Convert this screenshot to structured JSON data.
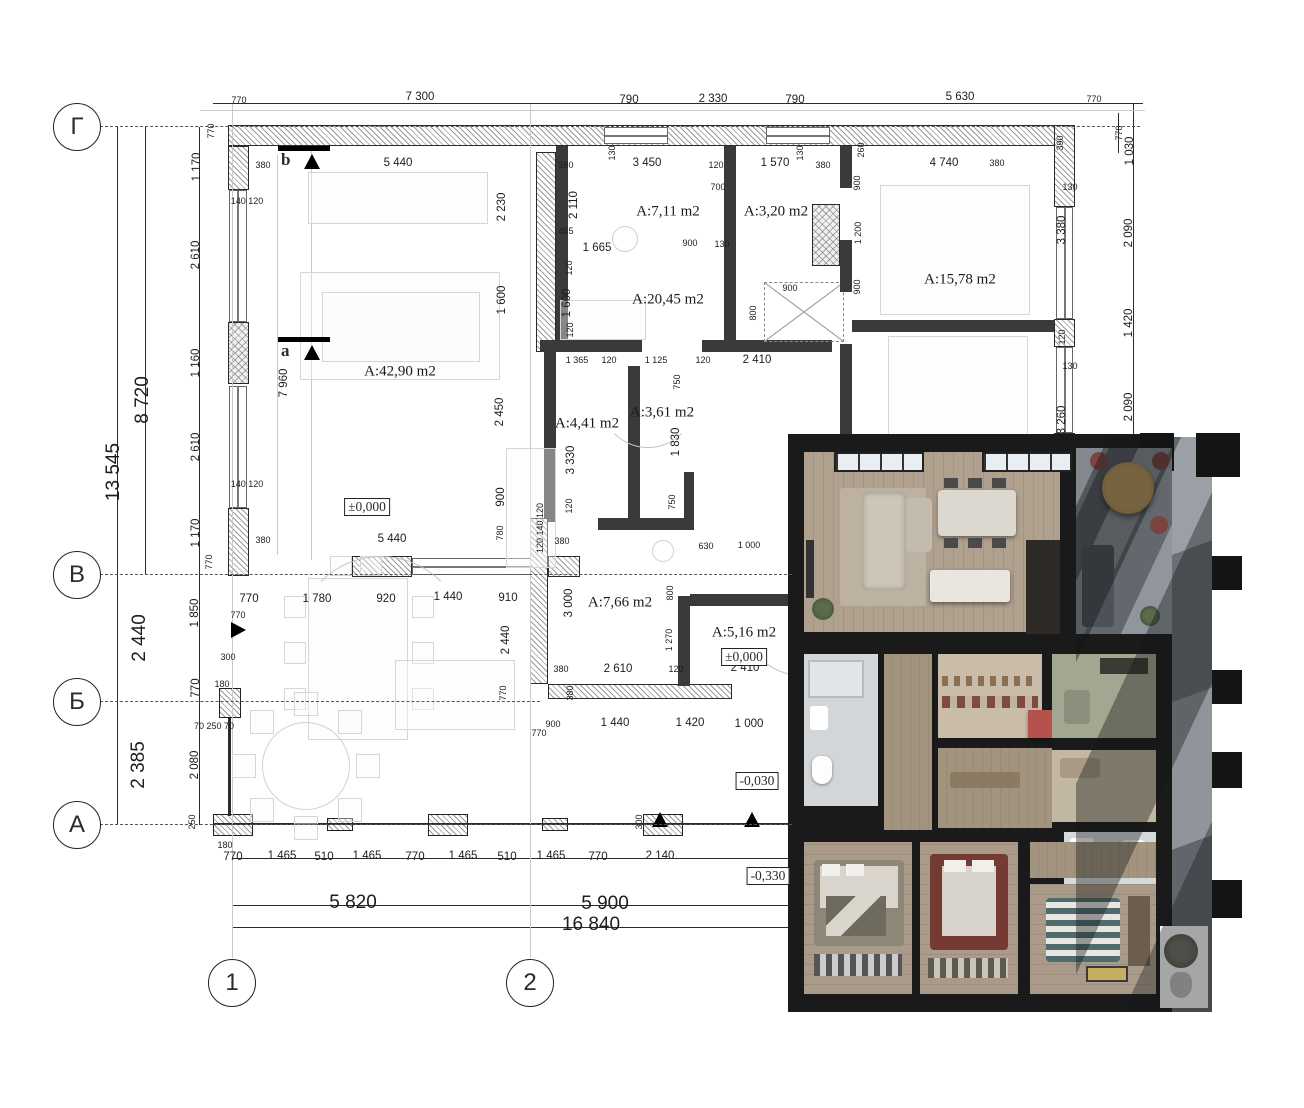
{
  "title": "apartment floor plan with 3d render overlay",
  "colors": {
    "plan_line": "#2b2b2b",
    "wall_hatch": "#9a9a9a",
    "render_wall": "#1a1a1a",
    "render_wood": "#ab9c8b",
    "render_terrace": "#8d9398",
    "render_accent_red": "#b5524c"
  },
  "axes": {
    "rows": [
      {
        "label": "Г",
        "y": 127
      },
      {
        "label": "В",
        "y": 575
      },
      {
        "label": "Б",
        "y": 702
      },
      {
        "label": "А",
        "y": 825
      }
    ],
    "cols": [
      {
        "label": "1",
        "x": 232
      },
      {
        "label": "2",
        "x": 530
      }
    ]
  },
  "rooms": [
    {
      "t": "A:42,90 m2",
      "x": 400,
      "y": 372
    },
    {
      "t": "A:7,11 m2",
      "x": 668,
      "y": 212
    },
    {
      "t": "A:3,20 m2",
      "x": 776,
      "y": 212
    },
    {
      "t": "A:20,45 m2",
      "x": 668,
      "y": 300
    },
    {
      "t": "A:15,78 m2",
      "x": 960,
      "y": 280
    },
    {
      "t": "A:4,41 m2",
      "x": 587,
      "y": 424
    },
    {
      "t": "A:3,61 m2",
      "x": 662,
      "y": 413
    },
    {
      "t": "A:7,66 m2",
      "x": 620,
      "y": 603
    },
    {
      "t": "A:5,16 m2",
      "x": 744,
      "y": 633
    }
  ],
  "levels": [
    {
      "t": "±0,000",
      "x": 367,
      "y": 507
    },
    {
      "t": "±0,000",
      "x": 744,
      "y": 657
    },
    {
      "t": "-0,030",
      "x": 757,
      "y": 781
    },
    {
      "t": "-0,330",
      "x": 768,
      "y": 876
    }
  ],
  "sections": [
    {
      "label": "b",
      "x": 287,
      "y": 158
    },
    {
      "label": "a",
      "x": 287,
      "y": 349
    }
  ],
  "dims": [
    {
      "t": "770",
      "x": 239,
      "y": 100,
      "s": 1
    },
    {
      "t": "7 300",
      "x": 420,
      "y": 97
    },
    {
      "t": "790",
      "x": 629,
      "y": 100
    },
    {
      "t": "2 330",
      "x": 713,
      "y": 99
    },
    {
      "t": "790",
      "x": 795,
      "y": 100
    },
    {
      "t": "5 630",
      "x": 960,
      "y": 97
    },
    {
      "t": "770",
      "x": 1094,
      "y": 99,
      "s": 1
    },
    {
      "t": "380",
      "x": 263,
      "y": 165,
      "s": 1
    },
    {
      "t": "5 440",
      "x": 398,
      "y": 163
    },
    {
      "t": "380",
      "x": 566,
      "y": 165,
      "s": 1
    },
    {
      "t": "3 450",
      "x": 647,
      "y": 163
    },
    {
      "t": "120",
      "x": 716,
      "y": 165,
      "s": 1
    },
    {
      "t": "1 570",
      "x": 775,
      "y": 163
    },
    {
      "t": "380",
      "x": 823,
      "y": 165,
      "s": 1
    },
    {
      "t": "260",
      "x": 861,
      "y": 150,
      "r": 1,
      "s": 1
    },
    {
      "t": "4 740",
      "x": 944,
      "y": 163
    },
    {
      "t": "380",
      "x": 997,
      "y": 163,
      "s": 1
    },
    {
      "t": "390",
      "x": 1060,
      "y": 143,
      "r": 1,
      "s": 1
    },
    {
      "t": "130",
      "x": 612,
      "y": 153,
      "r": 1,
      "s": 1
    },
    {
      "t": "130",
      "x": 800,
      "y": 153,
      "r": 1,
      "s": 1
    },
    {
      "t": "130",
      "x": 1070,
      "y": 187,
      "s": 1
    },
    {
      "t": "130",
      "x": 1070,
      "y": 366,
      "s": 1
    },
    {
      "t": "770",
      "x": 211,
      "y": 131,
      "r": 1,
      "s": 1
    },
    {
      "t": "1 170",
      "x": 197,
      "y": 167,
      "r": 1
    },
    {
      "t": "2 610",
      "x": 196,
      "y": 255,
      "r": 1
    },
    {
      "t": "1 160",
      "x": 196,
      "y": 363,
      "r": 1
    },
    {
      "t": "2 610",
      "x": 196,
      "y": 447,
      "r": 1
    },
    {
      "t": "1 170",
      "x": 196,
      "y": 533,
      "r": 1
    },
    {
      "t": "770",
      "x": 209,
      "y": 562,
      "r": 1,
      "s": 1
    },
    {
      "t": "8 720",
      "x": 143,
      "y": 400,
      "r": 1,
      "s": 4
    },
    {
      "t": "13 545",
      "x": 114,
      "y": 472,
      "r": 1,
      "s": 4
    },
    {
      "t": "1 850",
      "x": 195,
      "y": 613,
      "r": 1
    },
    {
      "t": "2 440",
      "x": 140,
      "y": 638,
      "r": 1,
      "s": 4
    },
    {
      "t": "770",
      "x": 196,
      "y": 688,
      "r": 1
    },
    {
      "t": "300",
      "x": 228,
      "y": 657,
      "s": 1
    },
    {
      "t": "180",
      "x": 222,
      "y": 684,
      "s": 1
    },
    {
      "t": "2 080",
      "x": 195,
      "y": 765,
      "r": 1
    },
    {
      "t": "2 385",
      "x": 139,
      "y": 765,
      "r": 1,
      "s": 4
    },
    {
      "t": "250",
      "x": 192,
      "y": 822,
      "r": 1,
      "s": 1
    },
    {
      "t": "70 250 70",
      "x": 214,
      "y": 726,
      "s": 1
    },
    {
      "t": "770",
      "x": 238,
      "y": 615,
      "s": 1
    },
    {
      "t": "770",
      "x": 1119,
      "y": 133,
      "r": 1,
      "s": 1
    },
    {
      "t": "1 030",
      "x": 1130,
      "y": 151,
      "r": 1
    },
    {
      "t": "2 090",
      "x": 1129,
      "y": 233,
      "r": 1
    },
    {
      "t": "1 420",
      "x": 1129,
      "y": 323,
      "r": 1
    },
    {
      "t": "2 090",
      "x": 1129,
      "y": 407,
      "r": 1
    },
    {
      "t": "2 230",
      "x": 502,
      "y": 207,
      "r": 1
    },
    {
      "t": "1 600",
      "x": 502,
      "y": 300,
      "r": 1
    },
    {
      "t": "2 450",
      "x": 500,
      "y": 412,
      "r": 1
    },
    {
      "t": "900",
      "x": 501,
      "y": 497,
      "r": 1
    },
    {
      "t": "780",
      "x": 500,
      "y": 533,
      "r": 1,
      "s": 1
    },
    {
      "t": "140 120",
      "x": 247,
      "y": 201,
      "s": 1
    },
    {
      "t": "140 120",
      "x": 247,
      "y": 484,
      "s": 1
    },
    {
      "t": "7 960",
      "x": 284,
      "y": 383,
      "r": 1
    },
    {
      "t": "2 110",
      "x": 574,
      "y": 205,
      "r": 1
    },
    {
      "t": "465",
      "x": 566,
      "y": 231,
      "s": 1
    },
    {
      "t": "1 665",
      "x": 597,
      "y": 248
    },
    {
      "t": "900",
      "x": 690,
      "y": 243,
      "s": 1
    },
    {
      "t": "130",
      "x": 722,
      "y": 244,
      "s": 1
    },
    {
      "t": "700",
      "x": 718,
      "y": 187,
      "s": 1
    },
    {
      "t": "120",
      "x": 569,
      "y": 268,
      "r": 1,
      "s": 1
    },
    {
      "t": "1 600",
      "x": 567,
      "y": 303,
      "r": 1
    },
    {
      "t": "120",
      "x": 570,
      "y": 330,
      "r": 1,
      "s": 1
    },
    {
      "t": "900",
      "x": 790,
      "y": 288,
      "s": 1
    },
    {
      "t": "800",
      "x": 753,
      "y": 313,
      "r": 1,
      "s": 1
    },
    {
      "t": "900",
      "x": 857,
      "y": 183,
      "r": 1,
      "s": 1
    },
    {
      "t": "1 200",
      "x": 858,
      "y": 233,
      "r": 1,
      "s": 1
    },
    {
      "t": "900",
      "x": 857,
      "y": 287,
      "r": 1,
      "s": 1
    },
    {
      "t": "3 380",
      "x": 1062,
      "y": 230,
      "r": 1
    },
    {
      "t": "120",
      "x": 1062,
      "y": 337,
      "r": 1,
      "s": 1
    },
    {
      "t": "3 260",
      "x": 1062,
      "y": 420,
      "r": 1
    },
    {
      "t": "1 365",
      "x": 577,
      "y": 360,
      "s": 1
    },
    {
      "t": "120",
      "x": 609,
      "y": 360,
      "s": 1
    },
    {
      "t": "1 125",
      "x": 656,
      "y": 360,
      "s": 1
    },
    {
      "t": "750",
      "x": 677,
      "y": 382,
      "r": 1,
      "s": 1
    },
    {
      "t": "120",
      "x": 703,
      "y": 360,
      "s": 1
    },
    {
      "t": "2 410",
      "x": 757,
      "y": 360
    },
    {
      "t": "3 330",
      "x": 571,
      "y": 460,
      "r": 1
    },
    {
      "t": "1 830",
      "x": 676,
      "y": 442,
      "r": 1
    },
    {
      "t": "750",
      "x": 672,
      "y": 502,
      "r": 1,
      "s": 1
    },
    {
      "t": "120",
      "x": 569,
      "y": 506,
      "r": 1,
      "s": 1
    },
    {
      "t": "380",
      "x": 562,
      "y": 541,
      "s": 1
    },
    {
      "t": "120 140 120",
      "x": 540,
      "y": 528,
      "r": 1,
      "s": 1
    },
    {
      "t": "630",
      "x": 706,
      "y": 546,
      "s": 1
    },
    {
      "t": "1 000",
      "x": 749,
      "y": 545,
      "s": 1
    },
    {
      "t": "3 000",
      "x": 569,
      "y": 603,
      "r": 1
    },
    {
      "t": "800",
      "x": 670,
      "y": 593,
      "r": 1,
      "s": 1
    },
    {
      "t": "1 270",
      "x": 669,
      "y": 640,
      "r": 1,
      "s": 1
    },
    {
      "t": "380",
      "x": 561,
      "y": 669,
      "s": 1
    },
    {
      "t": "2 610",
      "x": 618,
      "y": 669
    },
    {
      "t": "120",
      "x": 676,
      "y": 669,
      "s": 1
    },
    {
      "t": "2 410",
      "x": 745,
      "y": 668
    },
    {
      "t": "380",
      "x": 570,
      "y": 693,
      "r": 1,
      "s": 1
    },
    {
      "t": "900",
      "x": 553,
      "y": 724,
      "s": 1
    },
    {
      "t": "1 440",
      "x": 615,
      "y": 723
    },
    {
      "t": "1 420",
      "x": 690,
      "y": 723
    },
    {
      "t": "1 000",
      "x": 749,
      "y": 724
    },
    {
      "t": "770",
      "x": 539,
      "y": 733,
      "s": 1
    },
    {
      "t": "380",
      "x": 263,
      "y": 540,
      "s": 1
    },
    {
      "t": "5 440",
      "x": 392,
      "y": 539
    },
    {
      "t": "770",
      "x": 249,
      "y": 599
    },
    {
      "t": "1 780",
      "x": 317,
      "y": 599
    },
    {
      "t": "920",
      "x": 386,
      "y": 599
    },
    {
      "t": "1 440",
      "x": 448,
      "y": 597
    },
    {
      "t": "910",
      "x": 508,
      "y": 598
    },
    {
      "t": "2 440",
      "x": 506,
      "y": 640,
      "r": 1
    },
    {
      "t": "770",
      "x": 503,
      "y": 693,
      "r": 1,
      "s": 1
    },
    {
      "t": "770",
      "x": 233,
      "y": 857
    },
    {
      "t": "1 465",
      "x": 282,
      "y": 856
    },
    {
      "t": "510",
      "x": 324,
      "y": 857
    },
    {
      "t": "1 465",
      "x": 367,
      "y": 856
    },
    {
      "t": "770",
      "x": 415,
      "y": 857
    },
    {
      "t": "1 465",
      "x": 463,
      "y": 856
    },
    {
      "t": "510",
      "x": 507,
      "y": 857
    },
    {
      "t": "1 465",
      "x": 551,
      "y": 856
    },
    {
      "t": "770",
      "x": 598,
      "y": 857
    },
    {
      "t": "2 140",
      "x": 660,
      "y": 856
    },
    {
      "t": "5 820",
      "x": 353,
      "y": 903,
      "s": 4
    },
    {
      "t": "5 900",
      "x": 605,
      "y": 904,
      "s": 4
    },
    {
      "t": "16 840",
      "x": 591,
      "y": 925,
      "s": 4
    },
    {
      "t": "300",
      "x": 639,
      "y": 822,
      "r": 1,
      "s": 1
    },
    {
      "t": "180",
      "x": 225,
      "y": 845,
      "s": 1
    }
  ]
}
